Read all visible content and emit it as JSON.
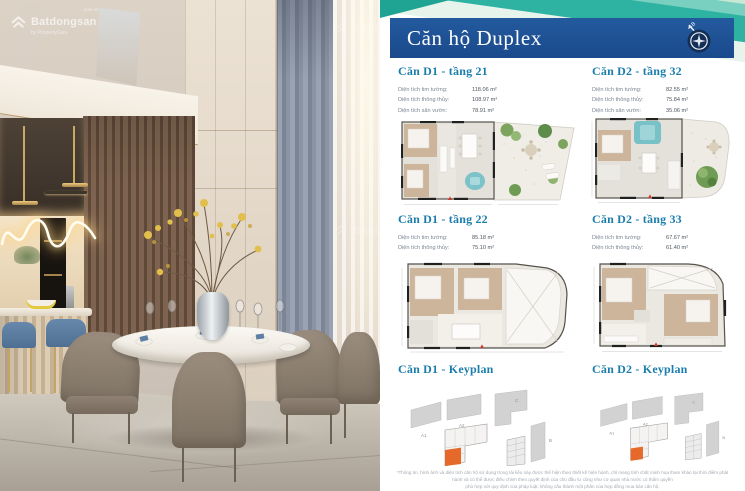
{
  "brand": {
    "name": "Batdongsan",
    "suffix": ".com.vn",
    "byline": "by PropertyGuru"
  },
  "header": {
    "title": "Căn hộ Duplex",
    "compass_north_label": "B"
  },
  "units": [
    {
      "title": "Căn D1 - tầng 21",
      "specs": [
        {
          "label": "Diện tích tim tường:",
          "value": "118.06 m²"
        },
        {
          "label": "Diện tích thông thủy:",
          "value": "108.97 m²"
        },
        {
          "label": "Diện tích sân vườn:",
          "value": "78.91 m²"
        }
      ]
    },
    {
      "title": "Căn D2 - tầng 32",
      "specs": [
        {
          "label": "Diện tích tim tường:",
          "value": "82.55 m²"
        },
        {
          "label": "Diện tích thông thủy:",
          "value": "75.84 m²"
        },
        {
          "label": "Diện tích sân vườn:",
          "value": "35.06 m²"
        }
      ]
    },
    {
      "title": "Căn D1 - tầng 22",
      "specs": [
        {
          "label": "Diện tích tim tường:",
          "value": "85.18 m²"
        },
        {
          "label": "Diện tích thông thủy:",
          "value": "75.10 m²"
        }
      ]
    },
    {
      "title": "Căn D2 - tầng 33",
      "specs": [
        {
          "label": "Diện tích tim tường:",
          "value": "67.67 m²"
        },
        {
          "label": "Diện tích thông thủy:",
          "value": "61.40 m²"
        }
      ]
    }
  ],
  "keyplans": [
    {
      "title": "Căn D1 - Keyplan"
    },
    {
      "title": "Căn D2 - Keyplan"
    }
  ],
  "keyplan_building_labels": [
    "A1",
    "A2",
    "C",
    "B"
  ],
  "disclaimer": {
    "line1": "*Thông tin, hình ảnh và diện tích căn hộ sử dụng trong tài liệu này được thể hiện theo thiết kế hiện hành, chỉ mang tính chất minh họa tham khảo tại thời điểm phát hành và có thể được điều chỉnh theo quyết định của chủ đầu tư cũng như cơ quan nhà nước có thẩm quyền",
    "line2": "phù hợp với quy định của pháp luật; không cấu thành một phần của hợp đồng mua bán căn hộ."
  },
  "colors": {
    "banner_blue": "#1c4e91",
    "accent_teal": "#2eb3a2",
    "title_blue": "#1b7dab",
    "highlight_orange": "#e4692b"
  }
}
